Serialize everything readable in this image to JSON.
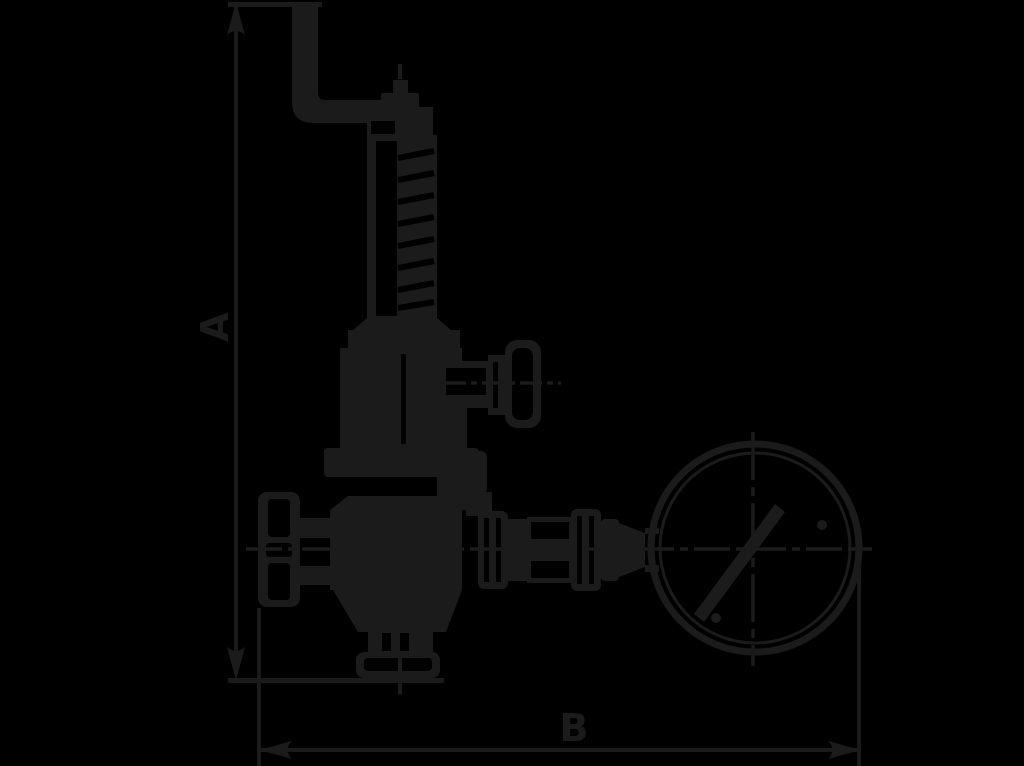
{
  "diagram": {
    "type": "technical-line-drawing",
    "subject": "safety relief valve with test lever, handwheel and pressure gauge",
    "colors": {
      "background": "#000000",
      "line": "#1b1b1b"
    },
    "dimensions": {
      "height_label": "A",
      "width_label": "B"
    }
  }
}
